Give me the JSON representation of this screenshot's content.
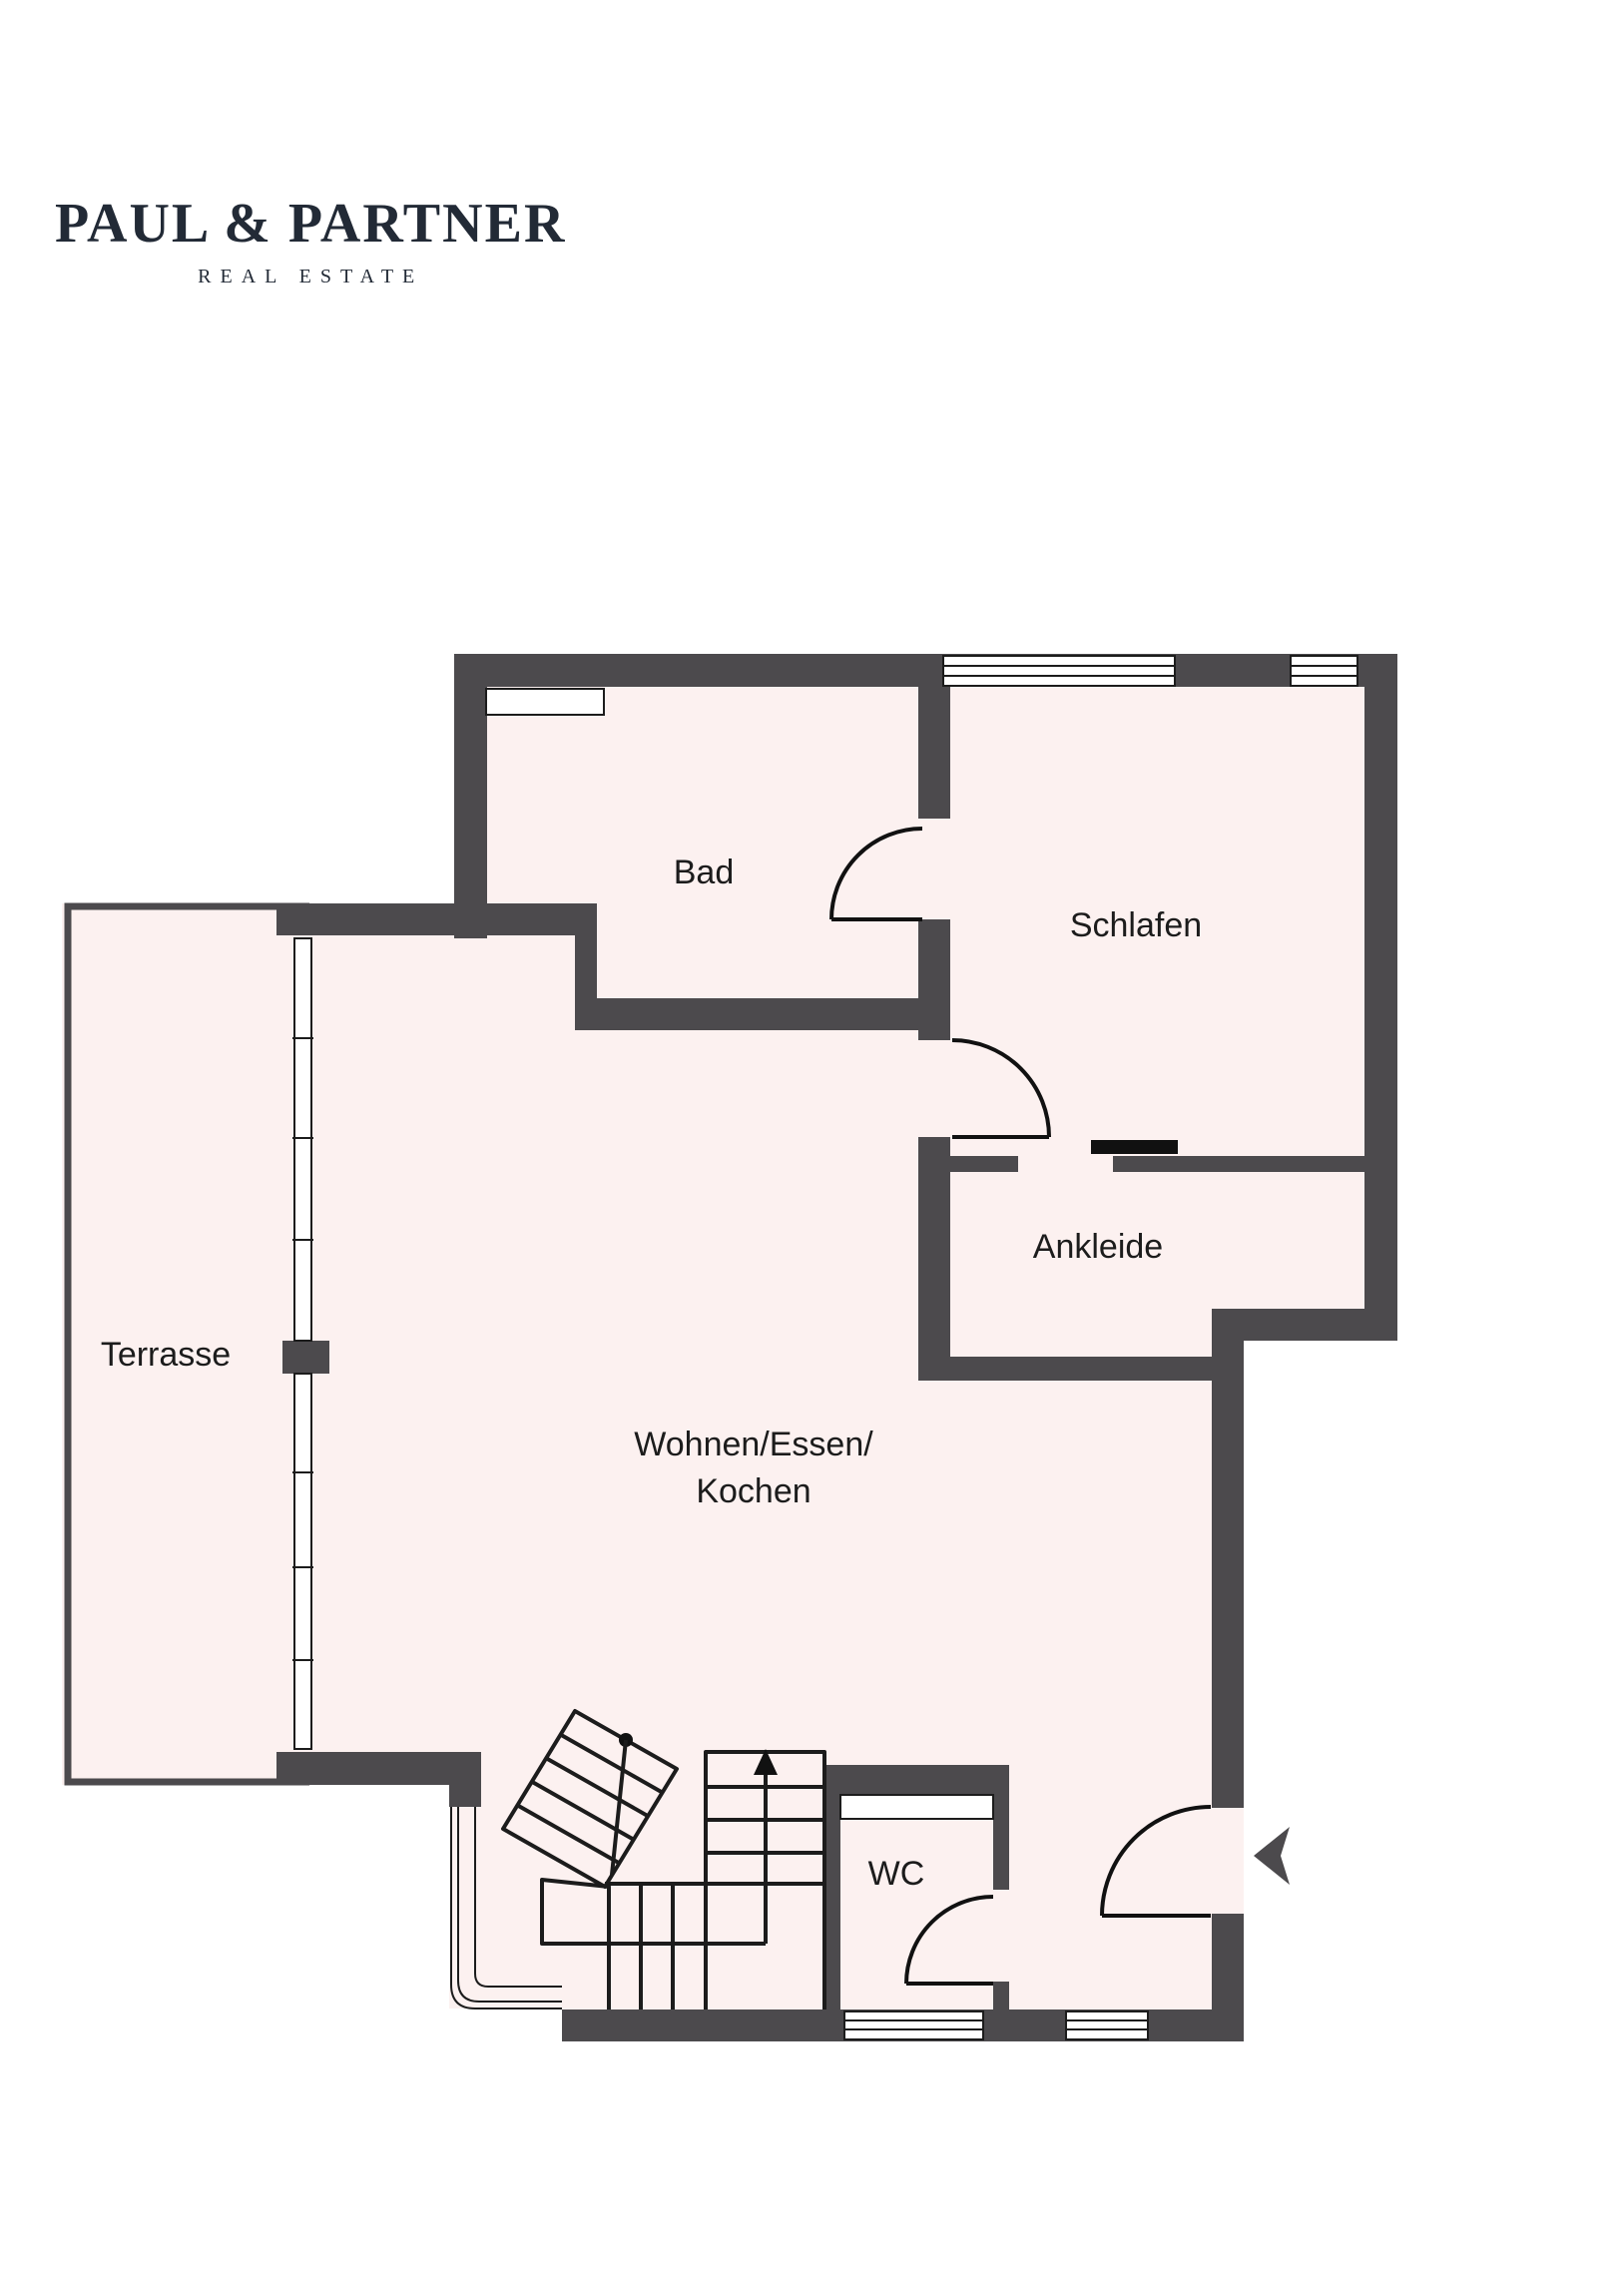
{
  "brand": {
    "name": "PAUL & PARTNER",
    "tagline": "REAL ESTATE"
  },
  "rooms": {
    "bad": "Bad",
    "schlafen": "Schlafen",
    "ankleide": "Ankleide",
    "terrasse": "Terrasse",
    "wohnen_line1": "Wohnen/Essen/",
    "wohnen_line2": "Kochen",
    "wc": "WC"
  },
  "colors": {
    "wall": "#4c4a4d",
    "floor": "#fcf1f0",
    "line": "#1c1c1c",
    "label": "#1c1c1c",
    "brand": "#222a36"
  }
}
